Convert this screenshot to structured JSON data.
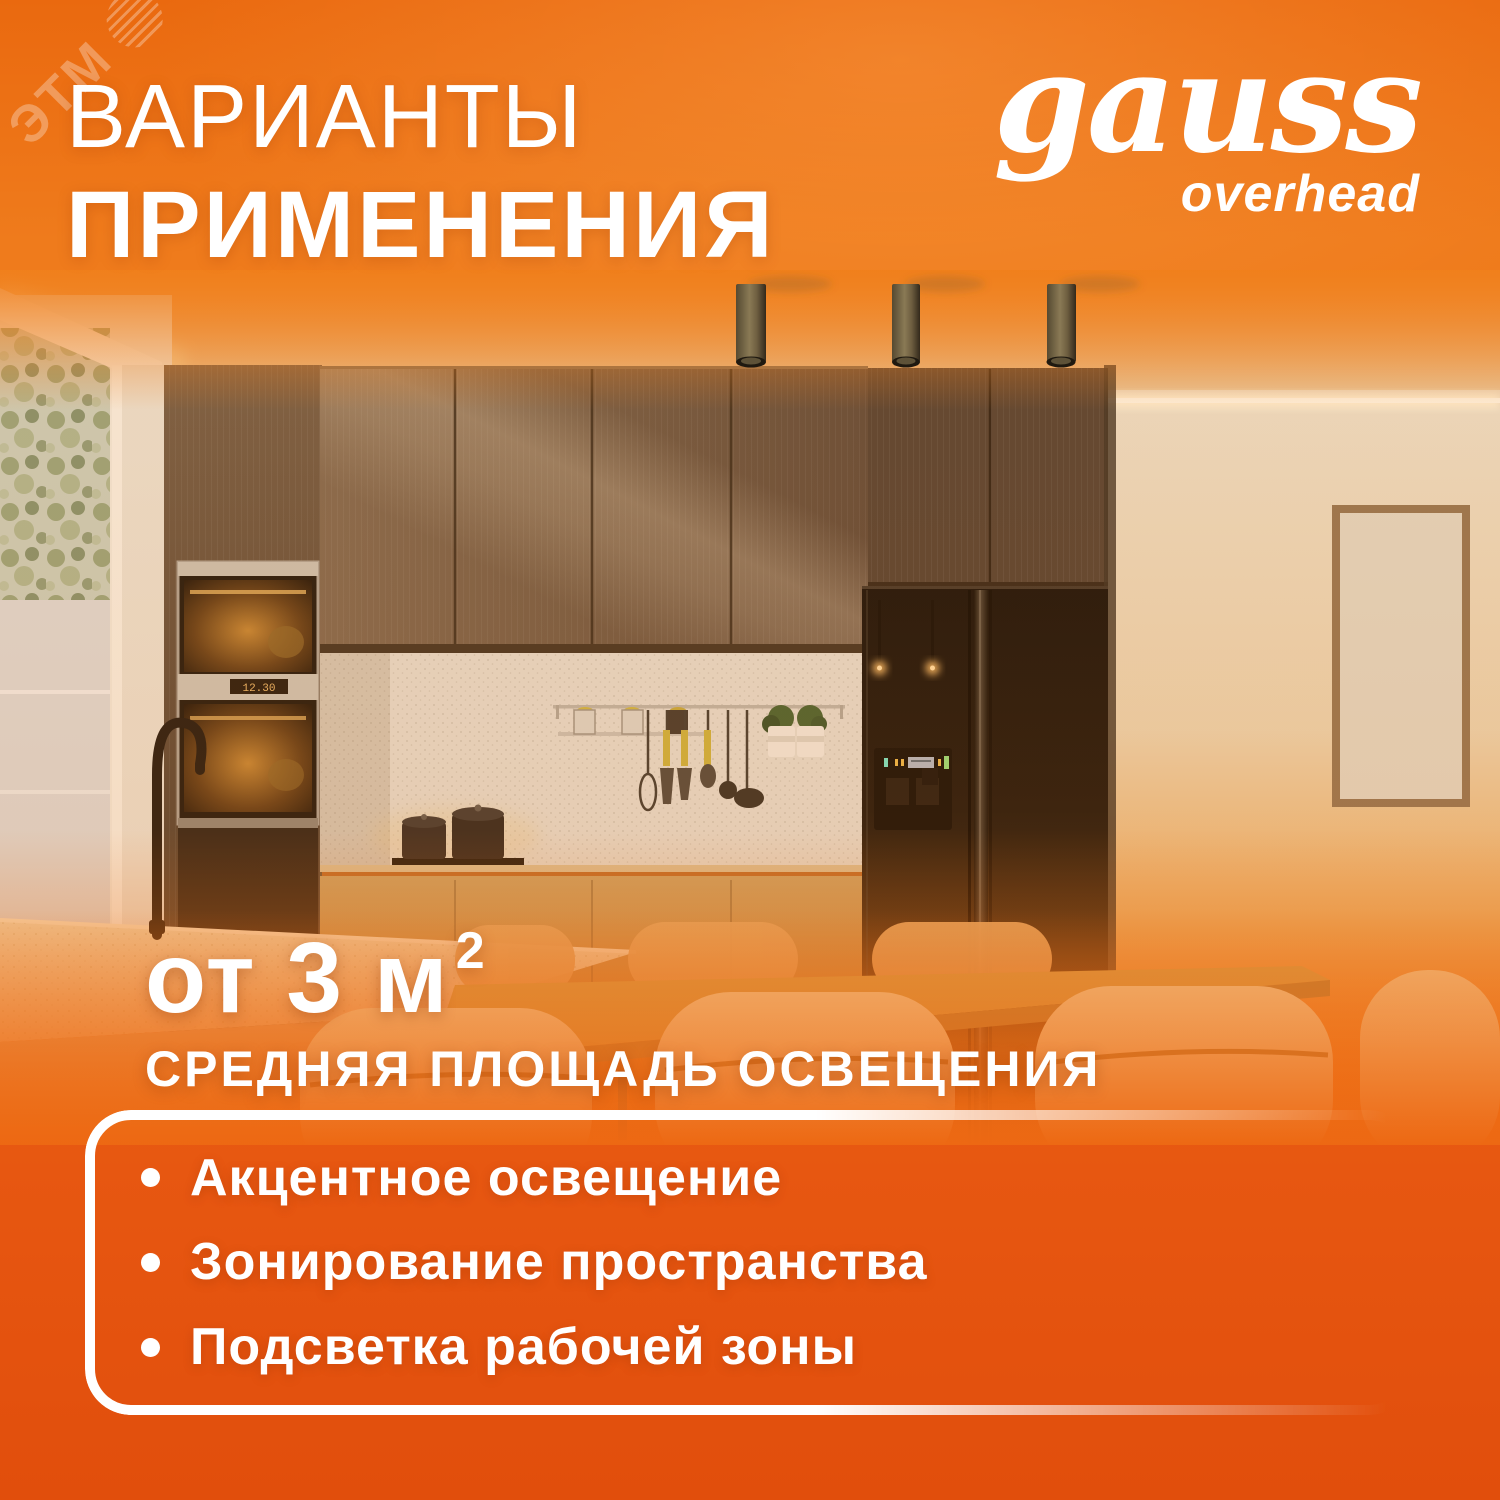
{
  "watermark": {
    "label": "ЭТМ",
    "icon": "striped-globe-icon"
  },
  "title": {
    "line1": "ВАРИАНТЫ",
    "line2": "ПРИМЕНЕНИЯ"
  },
  "brand": {
    "logo_text": "gauss",
    "logo_sub": "overhead"
  },
  "area": {
    "value": "от 3 м",
    "sup": "2",
    "caption": "СРЕДНЯЯ ПЛОЩАДЬ ОСВЕЩЕНИЯ"
  },
  "features": {
    "items": [
      {
        "label": "Акцентное освещение"
      },
      {
        "label": "Зонирование пространства"
      },
      {
        "label": "Подсветка рабочей зоны"
      }
    ]
  },
  "scene": {
    "description": "кухня с тремя накладными потолочными светильниками",
    "oven_display": "12.30"
  },
  "colors": {
    "accent_orange": "#EE6C10",
    "deep_orange": "#E24E0C",
    "light_orange": "#F08C2E",
    "white": "#FFFFFF",
    "led_teal": "#6FE8CE",
    "cabinet_brown": "#5E4A3B",
    "fridge_black": "#0D0A08"
  }
}
